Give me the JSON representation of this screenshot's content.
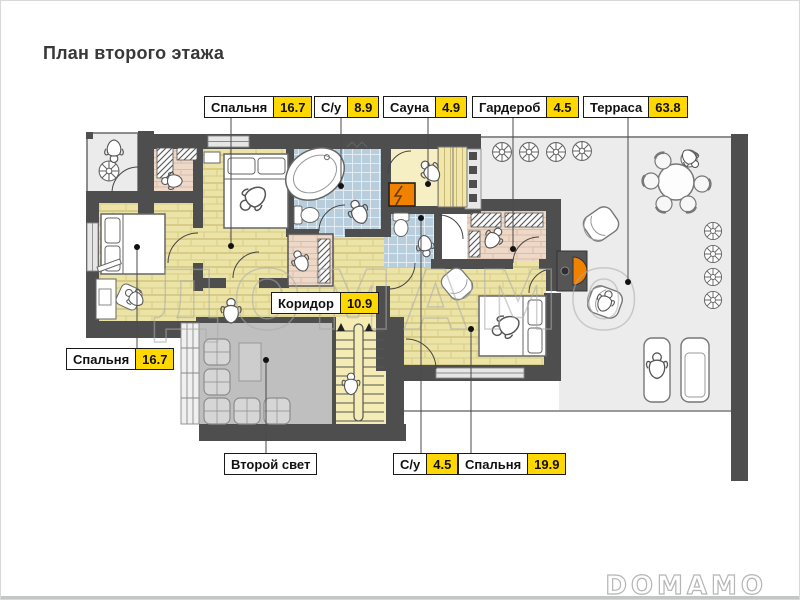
{
  "title": "План второго этажа",
  "watermark": "ДОМАМО",
  "brand": "DOMAMO",
  "labels": {
    "bedroom_top": {
      "name": "Спальня",
      "area": "16.7"
    },
    "bath_top": {
      "name": "С/у",
      "area": "8.9"
    },
    "sauna": {
      "name": "Сауна",
      "area": "4.9"
    },
    "wardrobe": {
      "name": "Гардероб",
      "area": "4.5"
    },
    "terrace": {
      "name": "Терраса",
      "area": "63.8"
    },
    "bedroom_left": {
      "name": "Спальня",
      "area": "16.7"
    },
    "corridor": {
      "name": "Коридор",
      "area": "10.9"
    },
    "void": {
      "name": "Второй свет"
    },
    "bath_bottom": {
      "name": "С/у",
      "area": "4.5"
    },
    "bedroom_bottom": {
      "name": "Спальня",
      "area": "19.9"
    }
  },
  "colors": {
    "area_badge": "#ffd800",
    "wall": "#4f4e4e",
    "wood_floor": "#ece4a6",
    "tile_floor": "#b9cedd",
    "sauna_floor": "#f7efc4",
    "wardrobe_floor": "#eed8c8",
    "terrace_floor": "#ececec",
    "void_floor": "#bfbfbf",
    "stove_orange": "#f08200"
  }
}
